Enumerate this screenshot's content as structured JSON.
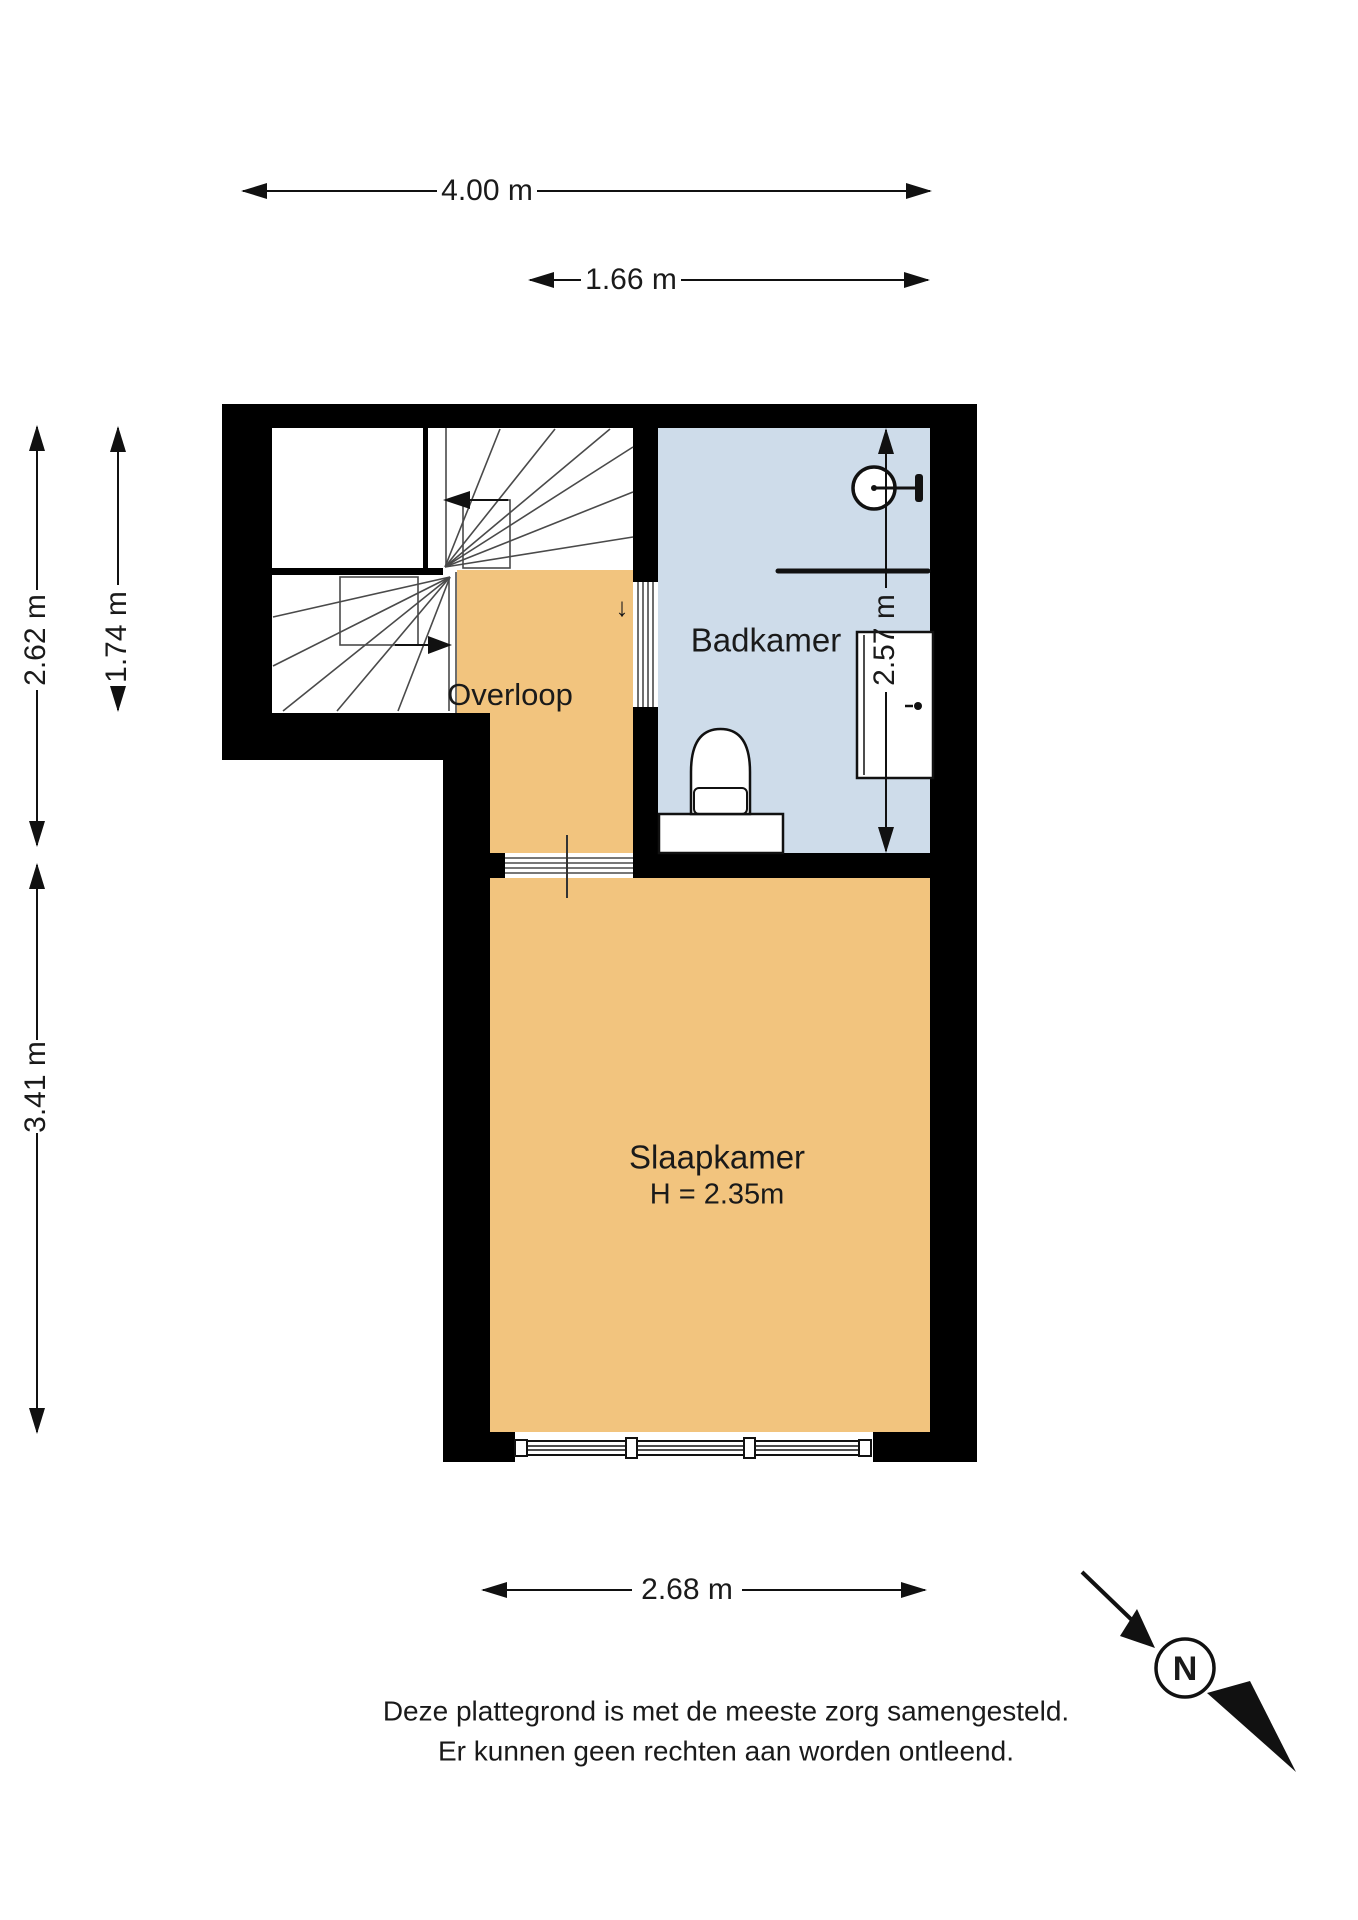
{
  "rooms": {
    "bathroom": {
      "label": "Badkamer"
    },
    "landing": {
      "label": "Overloop"
    },
    "bedroom": {
      "label": "Slaapkamer",
      "height_note": "H = 2.35m"
    }
  },
  "dimensions": {
    "top_total": "4.00 m",
    "top_bathroom": "1.66 m",
    "left_outer": "2.62 m",
    "left_inner": "1.74 m",
    "left_lower": "3.41 m",
    "right_bathroom": "2.57 m",
    "bottom_bedroom": "2.68 m"
  },
  "symbols": {
    "stairs_down_arrow": "↓",
    "north": "N"
  },
  "disclaimer": [
    "Deze plattegrond is met de meeste zorg samengesteld.",
    "Er kunnen geen rechten aan worden ontleend."
  ],
  "colors": {
    "wall": "#000000",
    "bathroom_floor": "#CEDCEA",
    "wood_floor": "#F2C47E",
    "text": "#1A1A1A"
  }
}
